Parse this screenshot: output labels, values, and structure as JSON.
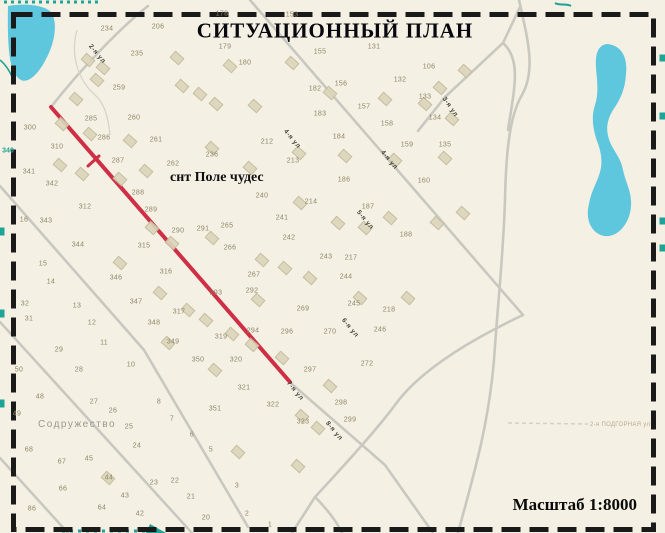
{
  "title": "СИТУАЦИОННЫЙ ПЛАН",
  "scale_label": "Масштаб 1:8000",
  "map": {
    "settlement_label": "снт Поле чудес",
    "neighbor_label": "Содружество",
    "road_label_bottom_right": "2-я ПОДГОРНАЯ ул",
    "colors": {
      "background": "#f4f0e3",
      "road": "#c9c8c0",
      "road_thin": "#d6d4cb",
      "route_red": "#cf2f45",
      "water": "#5ec6dd",
      "border": "#1a1a1a",
      "edge_marks": "#1fa396"
    },
    "street_labels": [
      {
        "text": "2-я ул",
        "x": 97,
        "y": 54,
        "rot": 50
      },
      {
        "text": "3-я ул",
        "x": 450,
        "y": 107,
        "rot": 55
      },
      {
        "text": "4-я ул",
        "x": 292,
        "y": 139,
        "rot": 50
      },
      {
        "text": "4-я ул",
        "x": 389,
        "y": 160,
        "rot": 50
      },
      {
        "text": "5-я ул",
        "x": 365,
        "y": 220,
        "rot": 50
      },
      {
        "text": "6-я ул",
        "x": 350,
        "y": 328,
        "rot": 50
      },
      {
        "text": "7-я ул",
        "x": 295,
        "y": 391,
        "rot": 50
      },
      {
        "text": "8-я ул",
        "x": 334,
        "y": 431,
        "rot": 50
      }
    ],
    "edge_labels": [
      {
        "text": "340",
        "x": 8,
        "y": 151
      }
    ],
    "plot_numbers": [
      {
        "t": "178",
        "x": 222,
        "y": 14
      },
      {
        "t": "153",
        "x": 292,
        "y": 15
      },
      {
        "t": "206",
        "x": 158,
        "y": 27
      },
      {
        "t": "234",
        "x": 107,
        "y": 29
      },
      {
        "t": "179",
        "x": 225,
        "y": 47
      },
      {
        "t": "235",
        "x": 137,
        "y": 54
      },
      {
        "t": "180",
        "x": 245,
        "y": 63
      },
      {
        "t": "155",
        "x": 320,
        "y": 52
      },
      {
        "t": "131",
        "x": 374,
        "y": 47
      },
      {
        "t": "106",
        "x": 429,
        "y": 67
      },
      {
        "t": "132",
        "x": 400,
        "y": 80
      },
      {
        "t": "156",
        "x": 341,
        "y": 84
      },
      {
        "t": "182",
        "x": 315,
        "y": 89
      },
      {
        "t": "133",
        "x": 425,
        "y": 97
      },
      {
        "t": "157",
        "x": 364,
        "y": 107
      },
      {
        "t": "183",
        "x": 320,
        "y": 114
      },
      {
        "t": "134",
        "x": 435,
        "y": 118
      },
      {
        "t": "158",
        "x": 387,
        "y": 124
      },
      {
        "t": "184",
        "x": 339,
        "y": 137
      },
      {
        "t": "159",
        "x": 407,
        "y": 145
      },
      {
        "t": "135",
        "x": 445,
        "y": 145
      },
      {
        "t": "212",
        "x": 267,
        "y": 142
      },
      {
        "t": "259",
        "x": 119,
        "y": 88
      },
      {
        "t": "285",
        "x": 91,
        "y": 119
      },
      {
        "t": "260",
        "x": 134,
        "y": 118
      },
      {
        "t": "300",
        "x": 30,
        "y": 128
      },
      {
        "t": "310",
        "x": 57,
        "y": 147
      },
      {
        "t": "286",
        "x": 104,
        "y": 138
      },
      {
        "t": "261",
        "x": 156,
        "y": 140
      },
      {
        "t": "287",
        "x": 118,
        "y": 161
      },
      {
        "t": "262",
        "x": 173,
        "y": 164
      },
      {
        "t": "341",
        "x": 29,
        "y": 172
      },
      {
        "t": "236",
        "x": 212,
        "y": 155
      },
      {
        "t": "213",
        "x": 293,
        "y": 161
      },
      {
        "t": "186",
        "x": 344,
        "y": 180
      },
      {
        "t": "240",
        "x": 262,
        "y": 196
      },
      {
        "t": "214",
        "x": 311,
        "y": 202
      },
      {
        "t": "187",
        "x": 368,
        "y": 207
      },
      {
        "t": "160",
        "x": 424,
        "y": 181
      },
      {
        "t": "342",
        "x": 52,
        "y": 184
      },
      {
        "t": "312",
        "x": 85,
        "y": 207
      },
      {
        "t": "288",
        "x": 138,
        "y": 193
      },
      {
        "t": "241",
        "x": 282,
        "y": 218
      },
      {
        "t": "343",
        "x": 46,
        "y": 221
      },
      {
        "t": "344",
        "x": 78,
        "y": 245
      },
      {
        "t": "289",
        "x": 151,
        "y": 210
      },
      {
        "t": "290",
        "x": 178,
        "y": 231
      },
      {
        "t": "291",
        "x": 203,
        "y": 229
      },
      {
        "t": "265",
        "x": 227,
        "y": 226
      },
      {
        "t": "242",
        "x": 289,
        "y": 238
      },
      {
        "t": "188",
        "x": 406,
        "y": 235
      },
      {
        "t": "16",
        "x": 24,
        "y": 220
      },
      {
        "t": "15",
        "x": 43,
        "y": 264
      },
      {
        "t": "266",
        "x": 230,
        "y": 248
      },
      {
        "t": "243",
        "x": 326,
        "y": 257
      },
      {
        "t": "217",
        "x": 351,
        "y": 258
      },
      {
        "t": "14",
        "x": 51,
        "y": 282
      },
      {
        "t": "346",
        "x": 116,
        "y": 278
      },
      {
        "t": "267",
        "x": 254,
        "y": 275
      },
      {
        "t": "244",
        "x": 346,
        "y": 277
      },
      {
        "t": "13",
        "x": 77,
        "y": 306
      },
      {
        "t": "347",
        "x": 136,
        "y": 302
      },
      {
        "t": "315",
        "x": 144,
        "y": 246
      },
      {
        "t": "316",
        "x": 166,
        "y": 272
      },
      {
        "t": "317",
        "x": 179,
        "y": 312
      },
      {
        "t": "32",
        "x": 25,
        "y": 304
      },
      {
        "t": "31",
        "x": 29,
        "y": 319
      },
      {
        "t": "12",
        "x": 92,
        "y": 323
      },
      {
        "t": "348",
        "x": 154,
        "y": 323
      },
      {
        "t": "293",
        "x": 216,
        "y": 293
      },
      {
        "t": "292",
        "x": 252,
        "y": 291
      },
      {
        "t": "269",
        "x": 303,
        "y": 309
      },
      {
        "t": "245",
        "x": 354,
        "y": 304
      },
      {
        "t": "218",
        "x": 389,
        "y": 310
      },
      {
        "t": "11",
        "x": 104,
        "y": 343
      },
      {
        "t": "349",
        "x": 173,
        "y": 342
      },
      {
        "t": "29",
        "x": 59,
        "y": 350
      },
      {
        "t": "294",
        "x": 253,
        "y": 331
      },
      {
        "t": "296",
        "x": 287,
        "y": 332
      },
      {
        "t": "270",
        "x": 330,
        "y": 332
      },
      {
        "t": "246",
        "x": 380,
        "y": 330
      },
      {
        "t": "272",
        "x": 367,
        "y": 364
      },
      {
        "t": "297",
        "x": 310,
        "y": 370
      },
      {
        "t": "319",
        "x": 221,
        "y": 337
      },
      {
        "t": "320",
        "x": 236,
        "y": 360
      },
      {
        "t": "298",
        "x": 341,
        "y": 403
      },
      {
        "t": "299",
        "x": 350,
        "y": 420
      },
      {
        "t": "321",
        "x": 244,
        "y": 388
      },
      {
        "t": "350",
        "x": 198,
        "y": 360
      },
      {
        "t": "10",
        "x": 131,
        "y": 365
      },
      {
        "t": "28",
        "x": 79,
        "y": 370
      },
      {
        "t": "50",
        "x": 19,
        "y": 370
      },
      {
        "t": "48",
        "x": 40,
        "y": 397
      },
      {
        "t": "27",
        "x": 94,
        "y": 402
      },
      {
        "t": "26",
        "x": 113,
        "y": 411
      },
      {
        "t": "8",
        "x": 159,
        "y": 402
      },
      {
        "t": "49",
        "x": 17,
        "y": 414
      },
      {
        "t": "25",
        "x": 129,
        "y": 427
      },
      {
        "t": "7",
        "x": 172,
        "y": 419
      },
      {
        "t": "351",
        "x": 215,
        "y": 409
      },
      {
        "t": "322",
        "x": 273,
        "y": 405
      },
      {
        "t": "323",
        "x": 303,
        "y": 422
      },
      {
        "t": "24",
        "x": 137,
        "y": 446
      },
      {
        "t": "6",
        "x": 192,
        "y": 435
      },
      {
        "t": "68",
        "x": 29,
        "y": 450
      },
      {
        "t": "45",
        "x": 89,
        "y": 459
      },
      {
        "t": "67",
        "x": 62,
        "y": 462
      },
      {
        "t": "5",
        "x": 211,
        "y": 450
      },
      {
        "t": "44",
        "x": 109,
        "y": 478
      },
      {
        "t": "23",
        "x": 154,
        "y": 483
      },
      {
        "t": "22",
        "x": 175,
        "y": 481
      },
      {
        "t": "66",
        "x": 63,
        "y": 489
      },
      {
        "t": "43",
        "x": 125,
        "y": 496
      },
      {
        "t": "21",
        "x": 191,
        "y": 497
      },
      {
        "t": "3",
        "x": 237,
        "y": 486
      },
      {
        "t": "86",
        "x": 32,
        "y": 509
      },
      {
        "t": "64",
        "x": 102,
        "y": 508
      },
      {
        "t": "42",
        "x": 140,
        "y": 514
      },
      {
        "t": "20",
        "x": 206,
        "y": 518
      },
      {
        "t": "2",
        "x": 247,
        "y": 514
      },
      {
        "t": "1",
        "x": 270,
        "y": 525
      }
    ],
    "buildings": [
      [
        88,
        60
      ],
      [
        103,
        68
      ],
      [
        97,
        80
      ],
      [
        76,
        99
      ],
      [
        177,
        58
      ],
      [
        230,
        66
      ],
      [
        182,
        86
      ],
      [
        200,
        94
      ],
      [
        216,
        104
      ],
      [
        255,
        106
      ],
      [
        292,
        63
      ],
      [
        330,
        93
      ],
      [
        385,
        99
      ],
      [
        440,
        88
      ],
      [
        465,
        71
      ],
      [
        425,
        104
      ],
      [
        452,
        119
      ],
      [
        62,
        124
      ],
      [
        90,
        134
      ],
      [
        130,
        141
      ],
      [
        60,
        165
      ],
      [
        82,
        174
      ],
      [
        120,
        179
      ],
      [
        146,
        171
      ],
      [
        212,
        148
      ],
      [
        250,
        168
      ],
      [
        299,
        153
      ],
      [
        345,
        156
      ],
      [
        395,
        160
      ],
      [
        445,
        158
      ],
      [
        300,
        203
      ],
      [
        338,
        223
      ],
      [
        390,
        218
      ],
      [
        437,
        223
      ],
      [
        463,
        213
      ],
      [
        212,
        238
      ],
      [
        262,
        260
      ],
      [
        310,
        278
      ],
      [
        360,
        298
      ],
      [
        408,
        298
      ],
      [
        152,
        228
      ],
      [
        172,
        243
      ],
      [
        120,
        263
      ],
      [
        160,
        293
      ],
      [
        206,
        320
      ],
      [
        252,
        345
      ],
      [
        282,
        358
      ],
      [
        330,
        386
      ],
      [
        302,
        416
      ],
      [
        318,
        428
      ],
      [
        238,
        452
      ],
      [
        108,
        478
      ],
      [
        298,
        466
      ],
      [
        215,
        370
      ],
      [
        168,
        343
      ],
      [
        365,
        228
      ],
      [
        285,
        268
      ],
      [
        232,
        334
      ],
      [
        258,
        300
      ],
      [
        188,
        310
      ]
    ]
  }
}
